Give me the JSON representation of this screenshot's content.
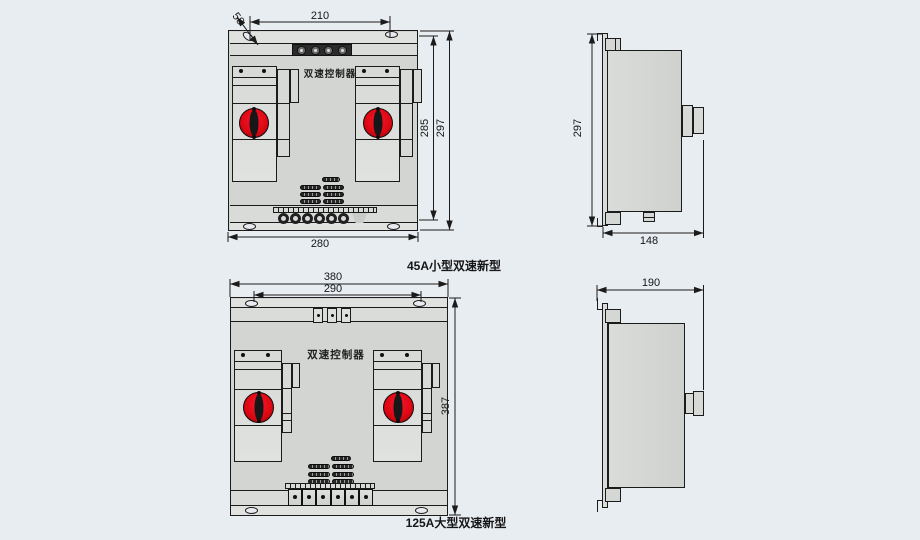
{
  "colors": {
    "background": "#e8edf2",
    "outline": "#1b1b1b",
    "panel_gray": "#d2d5d2",
    "panel_light": "#dfe2df",
    "knob_red": "#dd0712",
    "dark_strip": "#2b2b2b"
  },
  "front_45a": {
    "caption": "45A小型双速新型",
    "panel_label": "双速控制器",
    "dim_top_width": "210",
    "dim_mount_offset": "58",
    "dim_inner_height": "285",
    "dim_outer_height": "297",
    "dim_bottom_width": "280"
  },
  "side_45a": {
    "dim_height": "297",
    "dim_depth": "148"
  },
  "front_125a": {
    "caption": "125A大型双速新型",
    "panel_label": "双速控制器",
    "dim_outer_width": "380",
    "dim_mount_width": "290",
    "dim_height": "387"
  },
  "side_125a": {
    "dim_depth": "190"
  }
}
